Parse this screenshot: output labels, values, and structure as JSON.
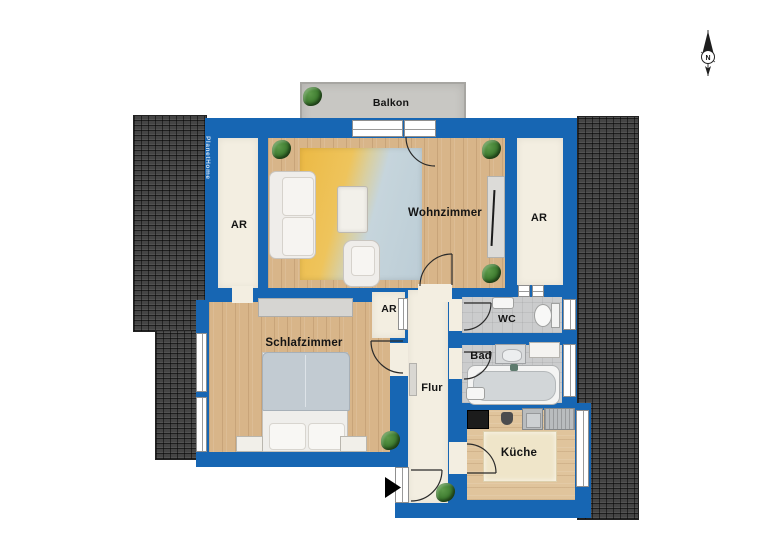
{
  "brand": "PlanetHome",
  "compass_label": "N",
  "labels": {
    "balkon": "Balkon",
    "wohnzimmer": "Wohnzimmer",
    "ar_left": "AR",
    "ar_right": "AR",
    "ar_mid": "AR",
    "schlafzimmer": "Schlafzimmer",
    "flur": "Flur",
    "wc": "WC",
    "bad": "Bad",
    "kueche": "Küche"
  },
  "colors": {
    "wall": "#1766b3",
    "roof": "#454545",
    "wood": "#d8b589",
    "cream": "#f3eee1",
    "bath": "#cbcccd",
    "balcony": "#c8c7c3"
  }
}
